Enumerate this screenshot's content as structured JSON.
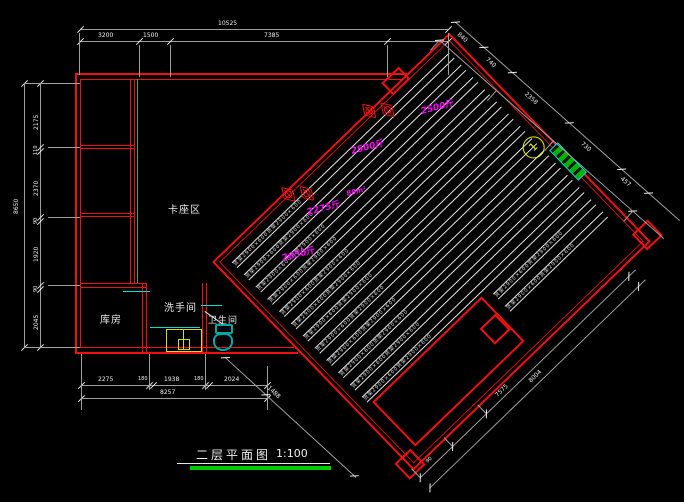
{
  "drawing": {
    "background": "#000000",
    "wall_color": "#f01010",
    "dim_line_color": "#9f9f9f",
    "dim_text_color": "#f0f0f0",
    "annotation_color": "#ff00ff",
    "partition_green": "#00c862",
    "counter_cyan": "#00dede",
    "sink_yellow": "#d8d820",
    "toilet_teal": "#00a8a8",
    "axis_yellow": "#f0f000",
    "door_green": "#00b400",
    "title_underline_green": "#00cc00"
  },
  "title_block": {
    "title": "二层平面图",
    "scale": "1:100"
  },
  "left_building": {
    "rooms": {
      "booth": {
        "label": "卡座区"
      },
      "storage": {
        "label": "库房"
      },
      "washroom": {
        "label": "洗手间"
      },
      "toilet": {
        "label": "卫生间"
      }
    }
  },
  "rotated_area": {
    "rotation_deg": -44,
    "rack_rows": {
      "count": 14,
      "label": "货架2900×600货架2900×600"
    },
    "capacity_labels": [
      {
        "text": "2500斤",
        "x": 420,
        "y": 104
      },
      {
        "text": "2500斤",
        "x": 350,
        "y": 144
      },
      {
        "text": "89m²",
        "x": 346,
        "y": 190
      },
      {
        "text": "2275斤",
        "x": 306,
        "y": 205
      },
      {
        "text": "2650斤",
        "x": 281,
        "y": 251
      }
    ],
    "axis_bubble": {
      "number": "1"
    }
  },
  "dimensions": {
    "top": {
      "total": "10525",
      "segments": [
        "3200",
        "1500",
        "7385"
      ]
    },
    "left": {
      "total": "8650",
      "segments": [
        "2175",
        "110",
        "2370",
        "90",
        "1920",
        "90",
        "2045"
      ]
    },
    "bottom": {
      "total": "8257",
      "segments": [
        "2275",
        "180",
        "1938",
        "180",
        "2024"
      ]
    },
    "rotated_top_edge": {
      "segments": [
        "840",
        "740",
        "2358",
        "730",
        "457"
      ]
    },
    "rotated_bottom_edge": {
      "line1": [
        "90",
        "7575"
      ],
      "line2": [
        "8004"
      ]
    },
    "rotated_left_edge": {
      "segments": [
        "1488"
      ]
    }
  }
}
